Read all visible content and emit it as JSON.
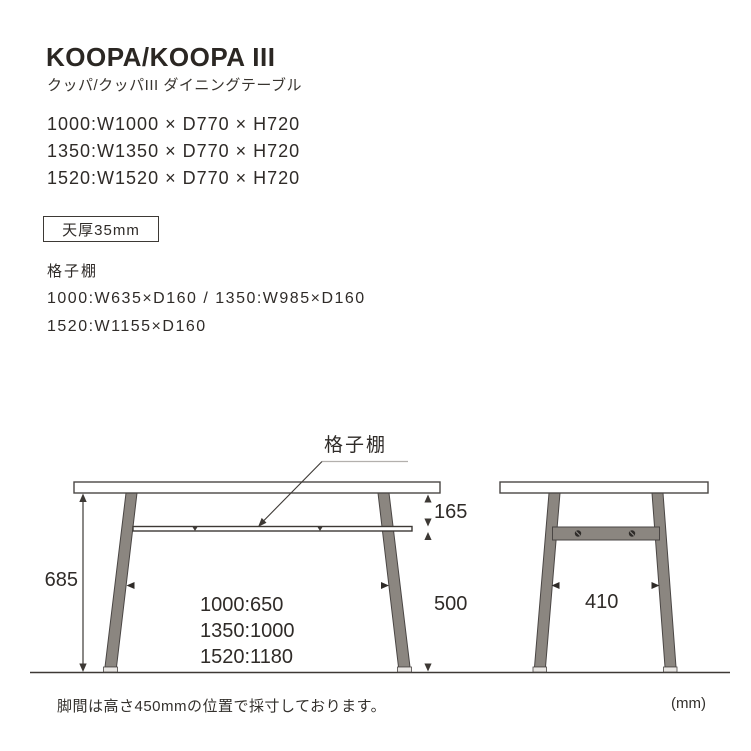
{
  "header": {
    "title": "KOOPA/KOOPA III",
    "subtitle": "クッパ/クッパIII ダイニングテーブル"
  },
  "sizes": [
    "1000:W1000 × D770 × H720",
    "1350:W1350 × D770 × H720",
    "1520:W1520 × D770 × H720"
  ],
  "top_thickness": {
    "label": "天厚35mm"
  },
  "shelf_spec": {
    "heading": "格子棚",
    "line1": "1000:W635×D160 / 1350:W985×D160",
    "line2": "1520:W1155×D160"
  },
  "diagram": {
    "shelf_label": "格子棚",
    "front": {
      "height": "685",
      "top_to_shelf": "165",
      "shelf_to_floor": "500",
      "spans": [
        "1000:650",
        "1350:1000",
        "1520:1180"
      ]
    },
    "side": {
      "span": "410"
    }
  },
  "footer": {
    "note": "脚間は高さ450mmの位置で採寸しております。",
    "unit": "(mm)"
  },
  "colors": {
    "ink": "#2f2b28",
    "line": "#3d3935",
    "leg_fill": "#8b8680",
    "leg_stroke": "#4a4644"
  }
}
